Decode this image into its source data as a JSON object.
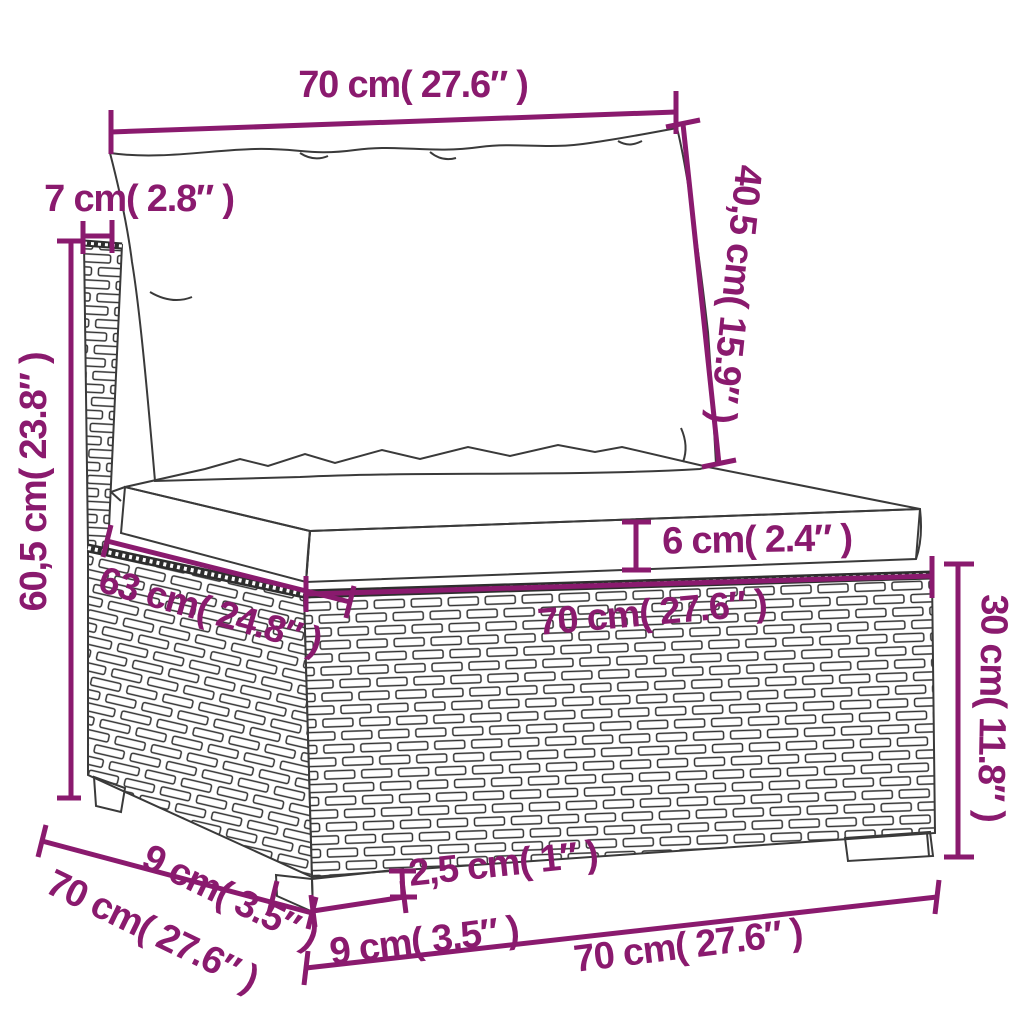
{
  "diagram": {
    "subject": "poly rattan garden sofa middle section with back and seat cushions, annotated dimension drawing",
    "colors": {
      "dimension_accent": "#8a1a6e",
      "sketch_line": "#3a3a3a",
      "background": "#ffffff"
    },
    "labels": {
      "top_width": {
        "text": "70 cm( 27.6″ )",
        "cm": "70",
        "inch": "27.6"
      },
      "back_cushion_height": {
        "text": "40,5 cm( 15.9″ )",
        "cm": "40,5",
        "inch": "15.9"
      },
      "back_post_width": {
        "text": "7 cm( 2.8″ )",
        "cm": "7",
        "inch": "2.8"
      },
      "total_height": {
        "text": "60,5 cm( 23.8″ )",
        "cm": "60,5",
        "inch": "23.8"
      },
      "seat_depth": {
        "text": "63 cm( 24.8″ )",
        "cm": "63",
        "inch": "24.8"
      },
      "seat_cushion_thickness": {
        "text": "6 cm( 2.4″ )",
        "cm": "6",
        "inch": "2.4"
      },
      "seat_width": {
        "text": "70 cm( 27.6″ )",
        "cm": "70",
        "inch": "27.6"
      },
      "base_height": {
        "text": "30 cm( 11.8″ )",
        "cm": "30",
        "inch": "11.8"
      },
      "foot_depth": {
        "text": "9 cm( 3.5″ )",
        "cm": "9",
        "inch": "3.5"
      },
      "base_depth": {
        "text": "70 cm( 27.6″ )",
        "cm": "70",
        "inch": "27.6"
      },
      "foot_width": {
        "text": "9 cm( 3.5″ )",
        "cm": "9",
        "inch": "3.5"
      },
      "foot_height": {
        "text": "2,5 cm( 1″ )",
        "cm": "2,5",
        "inch": "1"
      },
      "bottom_width": {
        "text": "70 cm( 27.6″ )",
        "cm": "70",
        "inch": "27.6"
      }
    }
  }
}
